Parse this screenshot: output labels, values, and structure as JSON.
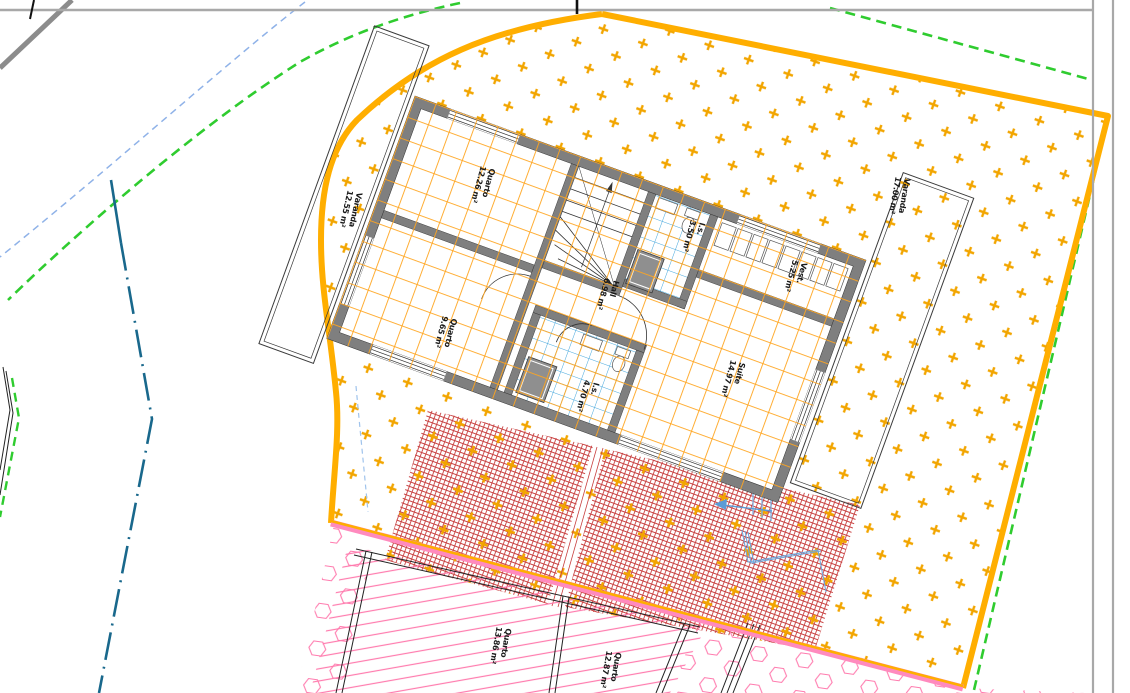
{
  "document": {
    "type": "architectural-floor-plan",
    "view": "upper floor plan with surrounding site plan"
  },
  "palette": {
    "boundary_orange": "#FFAE00",
    "terrain_plus_hatch": "#F2A500",
    "wall_gray": "#7F7F7F",
    "tile_grid_orange": "#FFA51F",
    "tile_grid_blue": "#45A7DC",
    "property_line_green": "#2FCC2F",
    "setback_line_blue": "#8FB2E8",
    "road_axis_teal": "#19688C",
    "lower_floor_pink": "#FF7BAE",
    "patio_brick_red": "#C23030",
    "sheet_border_gray": "#A8A8A8"
  },
  "rooms": [
    {
      "id": "varanda-left",
      "name": "Varanda",
      "area": "12.55 m²"
    },
    {
      "id": "quarto-1",
      "name": "Quarto",
      "area": "12.26 m²"
    },
    {
      "id": "quarto-2",
      "name": "Quarto",
      "area": "9.65 m²"
    },
    {
      "id": "hall",
      "name": "Hall",
      "area": "6.98 m²"
    },
    {
      "id": "is-top",
      "name": "I.s.",
      "area": "3.50 m²"
    },
    {
      "id": "vest",
      "name": "Vest.",
      "area": "5.25 m²"
    },
    {
      "id": "suite",
      "name": "Suite",
      "area": "14.97 m²"
    },
    {
      "id": "varanda-right",
      "name": "Varanda",
      "area": "17.00 m²"
    },
    {
      "id": "is-bottom",
      "name": "I.s.",
      "area": "4.70 m²"
    },
    {
      "id": "quarto-3",
      "name": "Quarto",
      "area": "13.86 m²"
    },
    {
      "id": "quarto-4",
      "name": "Quarto",
      "area": "12.87 m²"
    }
  ]
}
